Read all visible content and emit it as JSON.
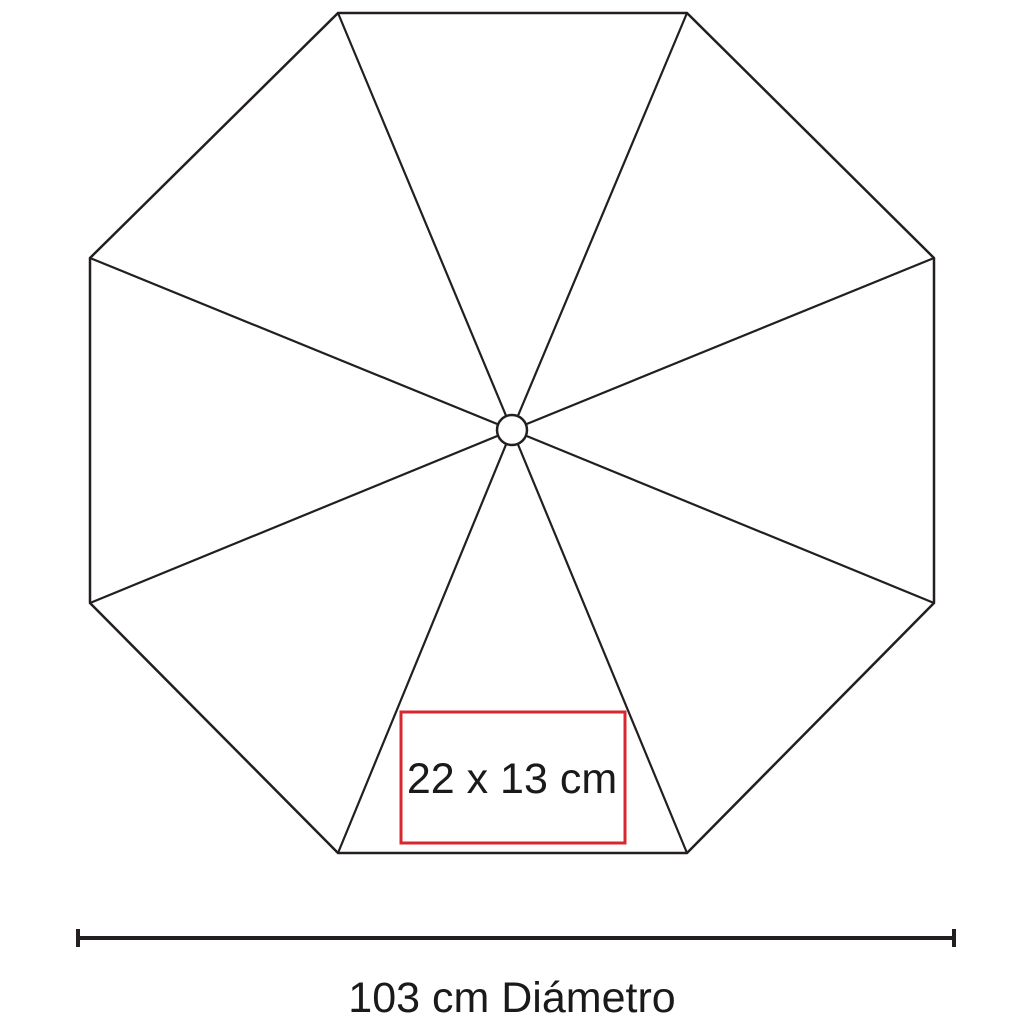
{
  "diagram": {
    "title": "umbrella-top-view-specification",
    "measurements": {
      "imprint_label": "22 x 13 cm",
      "diameter_label": "103 cm Diámetro"
    },
    "colors": {
      "line": "#231f20",
      "imprint_box": "#d7282f",
      "text": "#1a1a1a",
      "background": "#ffffff",
      "hub_fill": "#ffffff"
    }
  }
}
